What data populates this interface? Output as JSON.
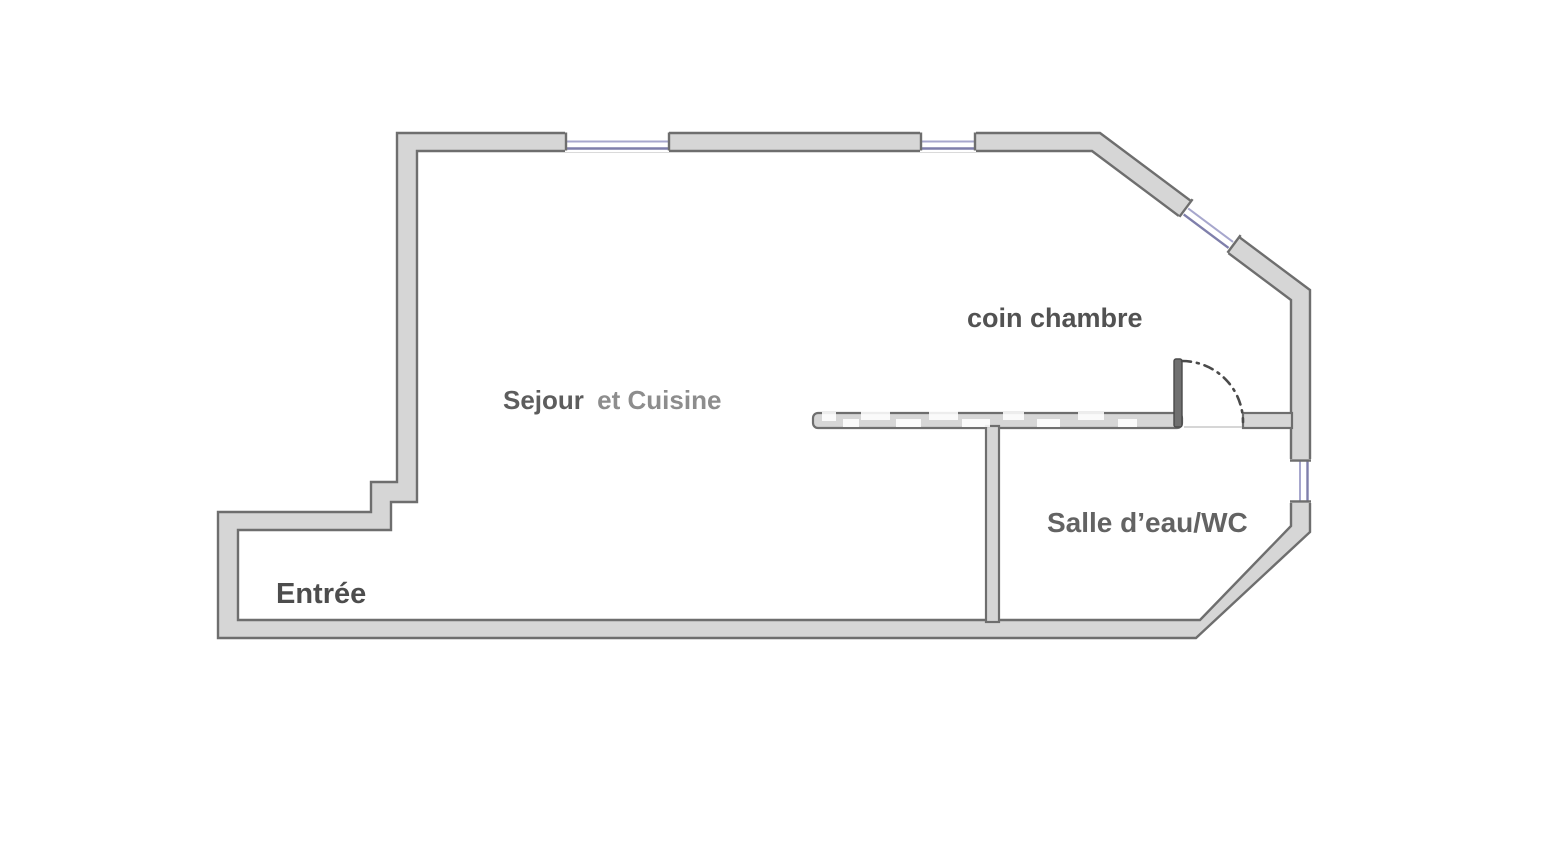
{
  "canvas": {
    "width": 1564,
    "height": 852,
    "background": "#ffffff"
  },
  "colors": {
    "wall_fill": "#d6d6d6",
    "wall_stroke": "#6e6e6e",
    "window_frame": "#7f7fab",
    "window_glass": "#a7a7cd",
    "door": "#4a4a4a",
    "door_leaf_fill": "#707070",
    "threshold": "#c9c9c9",
    "watermark": "#ffffff"
  },
  "rooms": {
    "living": {
      "label_main": "Sejour",
      "label_suffix": "et Cuisine",
      "color_main": "#5d5d5d",
      "color_suffix": "#8d8d8d"
    },
    "bedroom": {
      "label": "coin chambre",
      "color": "#525252"
    },
    "bathroom": {
      "label": "Salle d’eau/WC",
      "color": "#636363"
    },
    "entrance": {
      "label": "Entrée",
      "color": "#4d4d4d"
    }
  }
}
